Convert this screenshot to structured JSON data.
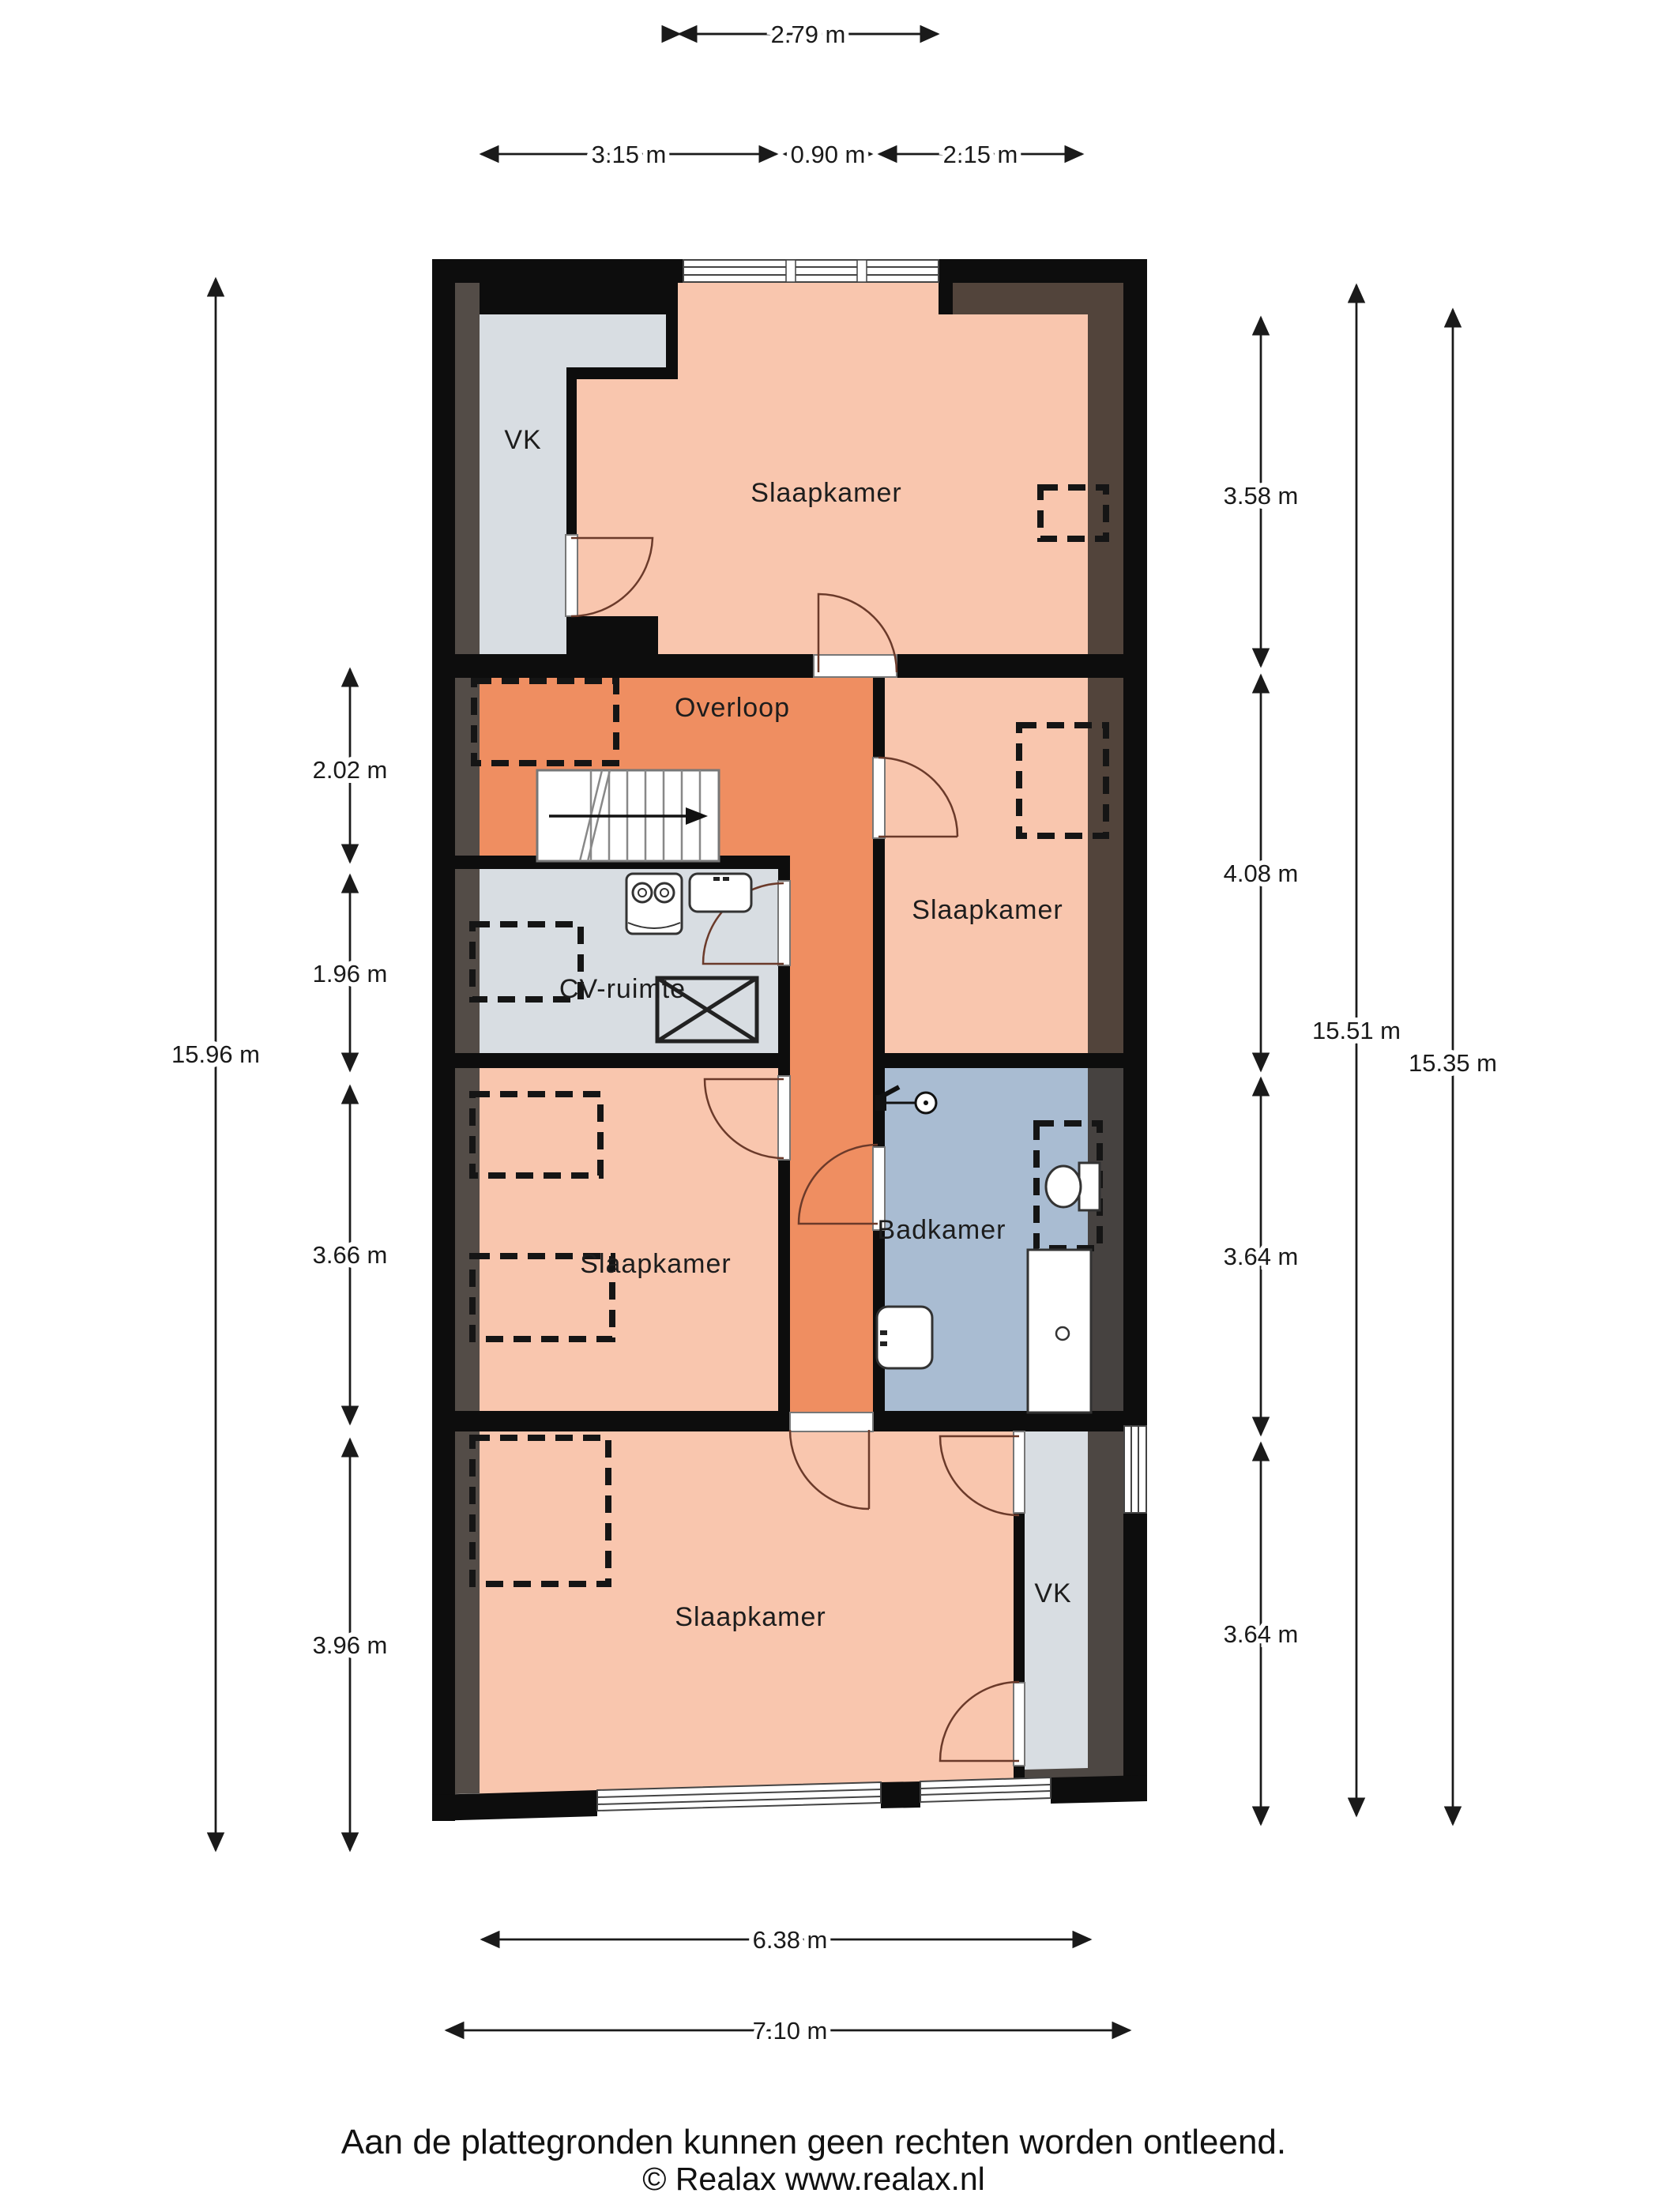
{
  "title": "Floor plan (plattegrond) - verdieping",
  "rooms": {
    "vk_top": "VK",
    "slaapkamer_top": "Slaapkamer",
    "overloop": "Overloop",
    "cv_ruimte": "CV-ruimte",
    "slaapkamer_right": "Slaapkamer",
    "slaapkamer_left": "Slaapkamer",
    "badkamer": "Badkamer",
    "slaapkamer_bottom": "Slaapkamer",
    "vk_bottom": "VK"
  },
  "dimensions": {
    "top": "2.79 m",
    "row2": [
      "3.15 m",
      "0.90 m",
      "2.15 m"
    ],
    "left_total": "15.96 m",
    "left": [
      "2.02 m",
      "1.96 m",
      "3.66 m",
      "3.96 m"
    ],
    "right": [
      "3.58 m",
      "4.08 m",
      "3.64 m",
      "3.64 m"
    ],
    "right_total_inner": "15.51 m",
    "right_total_outer": "15.35 m",
    "bottom_inner": "6.38 m",
    "bottom_outer": "7.10 m"
  },
  "footer": {
    "disclaimer": "Aan de plattegronden kunnen geen rechten worden ontleend.",
    "copyright": "© Realax www.realax.nl"
  },
  "colors": {
    "wall": "#0d0d0d",
    "bedroom_fill": "#f9c6ae",
    "hallway_fill": "#ef8e61",
    "utility_fill": "#d8dde2",
    "bathroom_fill": "#a9bcd2",
    "roof_band": "#352d27"
  }
}
